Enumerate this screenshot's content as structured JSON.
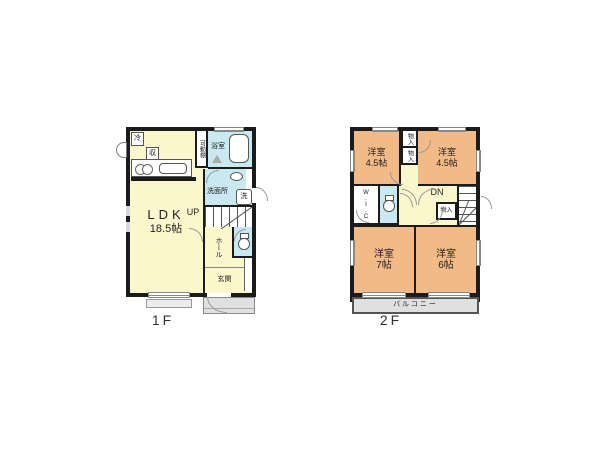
{
  "colors": {
    "yellow": "#FAF7CD",
    "orange": "#F2BA86",
    "cyan": "#C9E8EF",
    "gray": "#E0E0E0",
    "wall": "#1B1B1B"
  },
  "floor1": {
    "floor_label": "1F",
    "ldk_name": "LDK",
    "ldk_size": "18.5帖",
    "fridge": "冷",
    "storage": "収",
    "movable_shelf": "可動棚",
    "bath": "浴室",
    "washroom": "洗面所",
    "washer": "洗",
    "stairs": "UP",
    "hall": "ホール",
    "entrance": "玄関"
  },
  "floor2": {
    "floor_label": "2F",
    "room_nw_name": "洋室",
    "room_nw_size": "4.5帖",
    "room_ne_name": "洋室",
    "room_ne_size": "4.5帖",
    "room_sw_name": "洋室",
    "room_sw_size": "7帖",
    "room_se_name": "洋室",
    "room_se_size": "6帖",
    "closet_a": "物入",
    "closet_b": "物入",
    "closet_c": "物入",
    "wic": "W.I.C",
    "stairs": "DN",
    "balcony": "バルコニー"
  }
}
